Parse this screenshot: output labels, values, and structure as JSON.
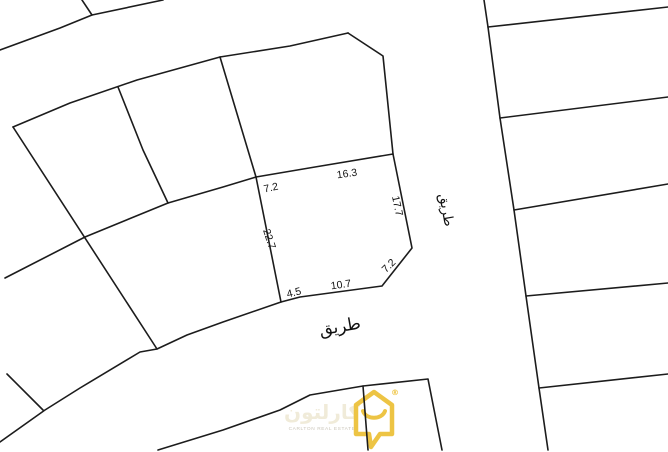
{
  "colors": {
    "background": "#ffffff",
    "boundary_line": "#1c1c1c",
    "logo_gold": "#edc13a",
    "logo_arabic_text": "#f0ead8",
    "logo_english_text": "#c7c2b6"
  },
  "plot": {
    "measurements": {
      "top_left_edge": "7.2",
      "top_edge": "16.3",
      "right_edge": "17.7",
      "left_edge": "22.7",
      "corner_cut": "7.2",
      "bottom_edge": "10.7",
      "bottom_left_edge": "4.5"
    }
  },
  "roads": {
    "vertical_road_label": "طريق",
    "horizontal_road_label": "طريق"
  },
  "watermark": {
    "icon": "house-chat-bubble-icon",
    "registered_symbol": "®",
    "brand_arabic": "كارلتون",
    "brand_english": "CARLTON REAL ESTATE"
  }
}
